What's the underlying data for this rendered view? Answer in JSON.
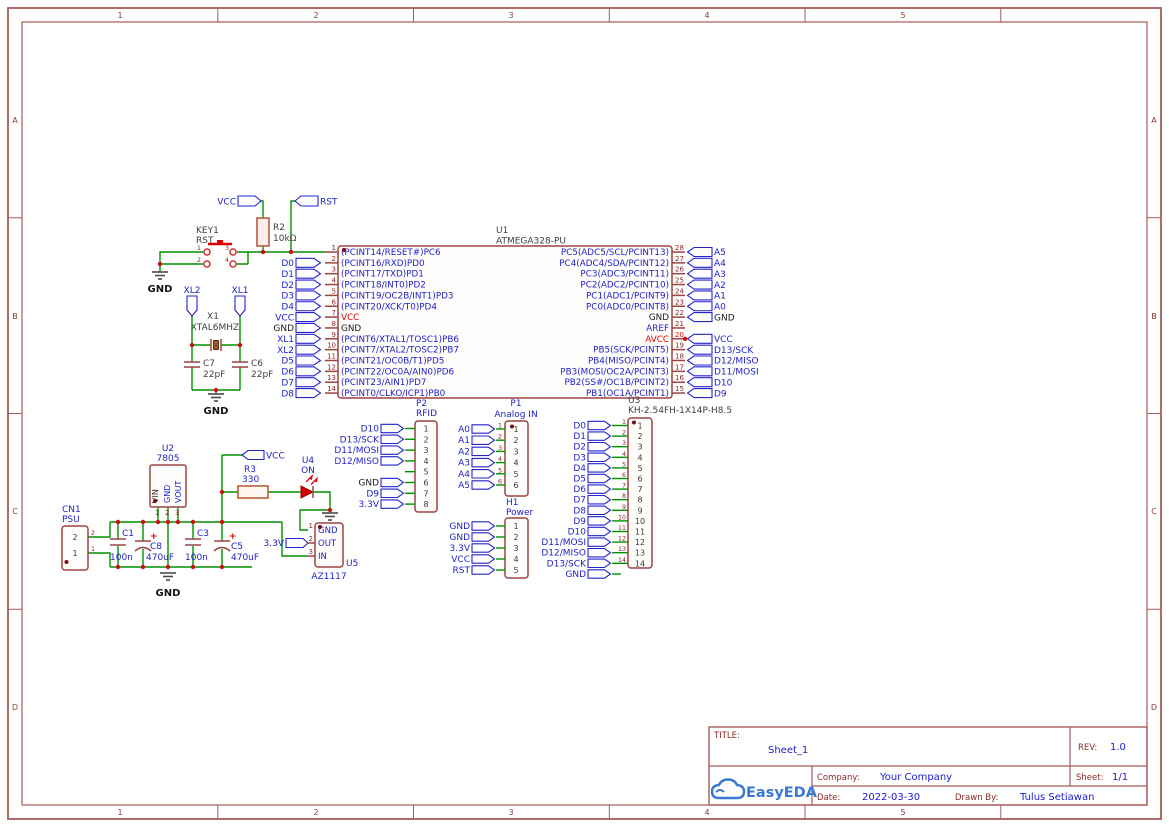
{
  "colors": {
    "wire_green": "#009100",
    "symbol_brick": "#9c4343",
    "net_blue": "#1e1ec8",
    "pin_number_darkred": "#8b2525",
    "power_red": "#e00000",
    "accent_red": "#dd0000",
    "label_gray": "#3f3f3f",
    "frame_brick": "#a85b5b",
    "title_darkred": "#8b2a2a",
    "logo_blue": "#3a78d2",
    "black": "#1a1a1a"
  },
  "frame": {
    "columns": [
      "1",
      "2",
      "3",
      "4",
      "5"
    ],
    "rows": [
      "A",
      "B",
      "C",
      "D"
    ]
  },
  "title_block": {
    "title_label": "TITLE:",
    "title": "Sheet_1",
    "rev_label": "REV:",
    "rev": "1.0",
    "company_label": "Company:",
    "company": "Your Company",
    "sheet_label": "Sheet:",
    "sheet": "1/1",
    "date_label": "Date:",
    "date": "2022-03-30",
    "drawn_label": "Drawn By:",
    "drawn_by": "Tulus Setiawan",
    "logo_text": "EasyEDA"
  },
  "net": {
    "gnd": "GND",
    "vcc": "VCC",
    "rst": "RST"
  },
  "key1": {
    "ref": "KEY1",
    "value": "RST",
    "pins": [
      "1",
      "2",
      "3",
      "4"
    ]
  },
  "r2": {
    "ref": "R2",
    "value": "10kΩ"
  },
  "xtal": {
    "ref": "X1",
    "value": "XTAL6MHZ",
    "xl2": "XL2",
    "xl1": "XL1"
  },
  "c7": {
    "ref": "C7",
    "value": "22pF"
  },
  "c6": {
    "ref": "C6",
    "value": "22pF"
  },
  "u1": {
    "ref": "U1",
    "value": "ATMEGA328-PU",
    "left_pins": [
      {
        "num": "1",
        "name": "(PCINT14/RESET#)PC6",
        "label": null,
        "dot": true
      },
      {
        "num": "2",
        "name": "(PCINT16/RXD)PD0",
        "label": "D0"
      },
      {
        "num": "3",
        "name": "(PCINT17/TXD)PD1",
        "label": "D1"
      },
      {
        "num": "4",
        "name": "(PCINT18/INT0)PD2",
        "label": "D2"
      },
      {
        "num": "5",
        "name": "(PCINT19/OC2B/INT1)PD3",
        "label": "D3"
      },
      {
        "num": "6",
        "name": "(PCINT20/XCK/T0)PD4",
        "label": "D4"
      },
      {
        "num": "7",
        "name": "VCC",
        "name_color": "#e00000",
        "label": "VCC"
      },
      {
        "num": "8",
        "name": "GND",
        "name_color": "#1a1a1a",
        "label": "GND",
        "label_color": "#1a1a1a"
      },
      {
        "num": "9",
        "name": "(PCINT6/XTAL1/TOSC1)PB6",
        "label": "XL1"
      },
      {
        "num": "10",
        "name": "(PCINT7/XTAL2/TOSC2)PB7",
        "label": "XL2"
      },
      {
        "num": "11",
        "name": "(PCINT21/OC0B/T1)PD5",
        "label": "D5"
      },
      {
        "num": "12",
        "name": "(PCINT22/OC0A/AIN0)PD6",
        "label": "D6"
      },
      {
        "num": "13",
        "name": "(PCINT23/AIN1)PD7",
        "label": "D7"
      },
      {
        "num": "14",
        "name": "(PCINT0/CLKO/ICP1)PB0",
        "label": "D8"
      }
    ],
    "right_pins": [
      {
        "num": "28",
        "name": "PC5(ADC5/SCL/PCINT13)",
        "label": "A5"
      },
      {
        "num": "27",
        "name": "PC4(ADC4/SDA/PCINT12)",
        "label": "A4"
      },
      {
        "num": "26",
        "name": "PC3(ADC3/PCINT11)",
        "label": "A3"
      },
      {
        "num": "25",
        "name": "PC2(ADC2/PCINT10)",
        "label": "A2"
      },
      {
        "num": "24",
        "name": "PC1(ADC1/PCINT9)",
        "label": "A1"
      },
      {
        "num": "23",
        "name": "PC0(ADC0/PCINT8)",
        "label": "A0"
      },
      {
        "num": "22",
        "name": "GND",
        "name_color": "#1a1a1a",
        "label": "GND",
        "label_color": "#1a1a1a"
      },
      {
        "num": "21",
        "name": "AREF",
        "label": null
      },
      {
        "num": "20",
        "name": "AVCC",
        "name_color": "#e00000",
        "num_color": "#ee0000",
        "label": "VCC",
        "dot": true
      },
      {
        "num": "19",
        "name": "PB5(SCK/PCINT5)",
        "label": "D13/SCK"
      },
      {
        "num": "18",
        "name": "PB4(MISO/PCINT4)",
        "label": "D12/MISO"
      },
      {
        "num": "17",
        "name": "PB3(MOSI/OC2A/PCINT3)",
        "label": "D11/MOSI"
      },
      {
        "num": "16",
        "name": "PB2(SS#/OC1B/PCINT2)",
        "label": "D10"
      },
      {
        "num": "15",
        "name": "PB1(OC1A/PCINT1)",
        "label": "D9"
      }
    ]
  },
  "cn1": {
    "ref": "CN1",
    "value": "PSU",
    "pins": [
      {
        "num": "2",
        "name": "2"
      },
      {
        "num": "1",
        "name": "1"
      }
    ]
  },
  "u2": {
    "ref": "U2",
    "value": "7805",
    "pins": [
      {
        "num": "1",
        "name": "VIN",
        "color": "#2b2b2b"
      },
      {
        "num": "2",
        "name": "GND",
        "color": "#1e1ec8"
      },
      {
        "num": "3",
        "name": "VOUT",
        "color": "#1e1ec8"
      }
    ]
  },
  "c1": {
    "ref": "C1",
    "value": "100n"
  },
  "c8": {
    "ref": "C8",
    "value": "470uF",
    "plus": "+"
  },
  "c3": {
    "ref": "C3",
    "value": "100n"
  },
  "c5": {
    "ref": "C5",
    "value": "470uF",
    "plus": "+"
  },
  "r3": {
    "ref": "R3",
    "value": "330"
  },
  "u4": {
    "ref": "U4",
    "value": "ON"
  },
  "u5": {
    "ref": "U5",
    "value": "AZ1117",
    "out_flag": "3.3V",
    "pins": [
      {
        "num": "1",
        "name": "GND"
      },
      {
        "num": "2",
        "name": "OUT"
      },
      {
        "num": "3",
        "name": "IN"
      }
    ]
  },
  "p2": {
    "ref": "P2",
    "value": "RFID",
    "pins": [
      {
        "num": "1",
        "name": "1",
        "label": "D10"
      },
      {
        "num": "2",
        "name": "2",
        "label": "D13/SCK"
      },
      {
        "num": "3",
        "name": "3",
        "label": "D11/MOSI"
      },
      {
        "num": "4",
        "name": "4",
        "label": "D12/MISO"
      },
      {
        "num": "5",
        "name": "5",
        "label": null
      },
      {
        "num": "6",
        "name": "6",
        "label": "GND",
        "label_color": "#1a1a1a"
      },
      {
        "num": "7",
        "name": "7",
        "label": "D9"
      },
      {
        "num": "8",
        "name": "8",
        "label": "3.3V"
      }
    ]
  },
  "p1": {
    "ref": "P1",
    "value": "Analog IN",
    "pins": [
      {
        "num": "1",
        "name": "1",
        "label": "A0"
      },
      {
        "num": "2",
        "name": "2",
        "label": "A1"
      },
      {
        "num": "3",
        "name": "3",
        "label": "A2"
      },
      {
        "num": "4",
        "name": "4",
        "label": "A3"
      },
      {
        "num": "5",
        "name": "5",
        "label": "A4"
      },
      {
        "num": "6",
        "name": "6",
        "label": "A5"
      }
    ]
  },
  "h1": {
    "ref": "H1",
    "value": "Power",
    "pins": [
      {
        "num": "1",
        "name": "1",
        "label": "GND"
      },
      {
        "num": "2",
        "name": "2",
        "label": "GND"
      },
      {
        "num": "3",
        "name": "3",
        "label": "3.3V"
      },
      {
        "num": "4",
        "name": "4",
        "label": "VCC"
      },
      {
        "num": "5",
        "name": "5",
        "label": "RST"
      }
    ]
  },
  "u3": {
    "ref": "U3",
    "value": "KH-2.54FH-1X14P-H8.5",
    "extra_gnd": "GND",
    "pins": [
      {
        "num": "1",
        "name": "1",
        "label": "D0",
        "dot": true
      },
      {
        "num": "2",
        "name": "2",
        "label": "D1"
      },
      {
        "num": "3",
        "name": "3",
        "label": "D2"
      },
      {
        "num": "4",
        "name": "4",
        "label": "D3"
      },
      {
        "num": "5",
        "name": "5",
        "label": "D4"
      },
      {
        "num": "6",
        "name": "6",
        "label": "D5"
      },
      {
        "num": "7",
        "name": "7",
        "label": "D6"
      },
      {
        "num": "8",
        "name": "8",
        "label": "D7"
      },
      {
        "num": "9",
        "name": "9",
        "label": "D8"
      },
      {
        "num": "10",
        "name": "10",
        "label": "D9"
      },
      {
        "num": "11",
        "name": "11",
        "label": "D10"
      },
      {
        "num": "12",
        "name": "12",
        "label": "D11/MOSI"
      },
      {
        "num": "13",
        "name": "13",
        "label": "D12/MISO"
      },
      {
        "num": "14",
        "name": "14",
        "label": "D13/SCK"
      }
    ]
  }
}
